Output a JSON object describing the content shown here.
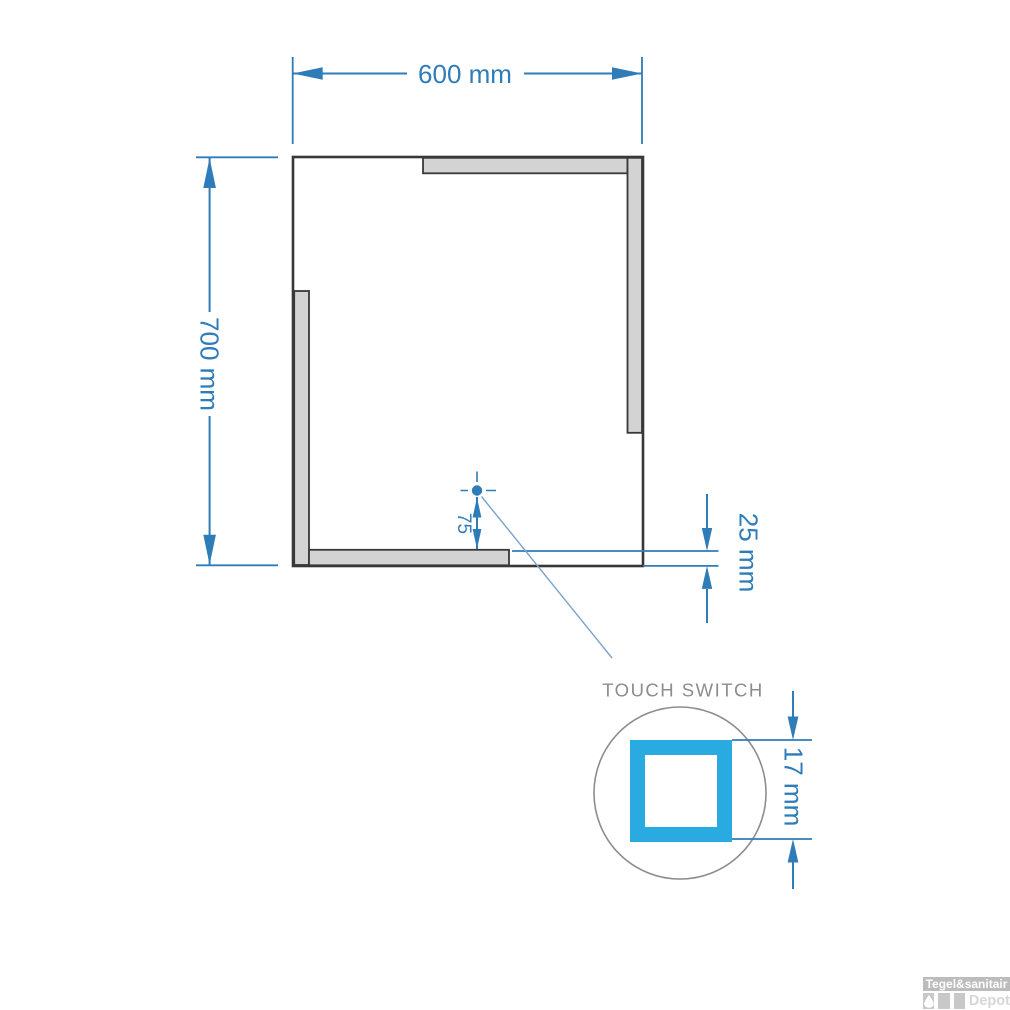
{
  "diagram": {
    "dimension_labels": {
      "width": "600 mm",
      "height": "700 mm",
      "strip": "25 mm",
      "switch_offset": "75",
      "switch_size": "17 mm"
    },
    "detail_label": "TOUCH SWITCH",
    "colors": {
      "dimension_blue": "#2e7cb8",
      "leader_blue": "#7ba2cc",
      "strip_gray": "#d3d3d3",
      "outline_dark": "#383838",
      "detail_gray": "#8d8d8d",
      "switch_cyan": "#29abe2",
      "logo_gray": "#bcbcbc"
    }
  },
  "watermark": {
    "brand": "Tegel&sanitair",
    "sub_brand": "Depot"
  }
}
